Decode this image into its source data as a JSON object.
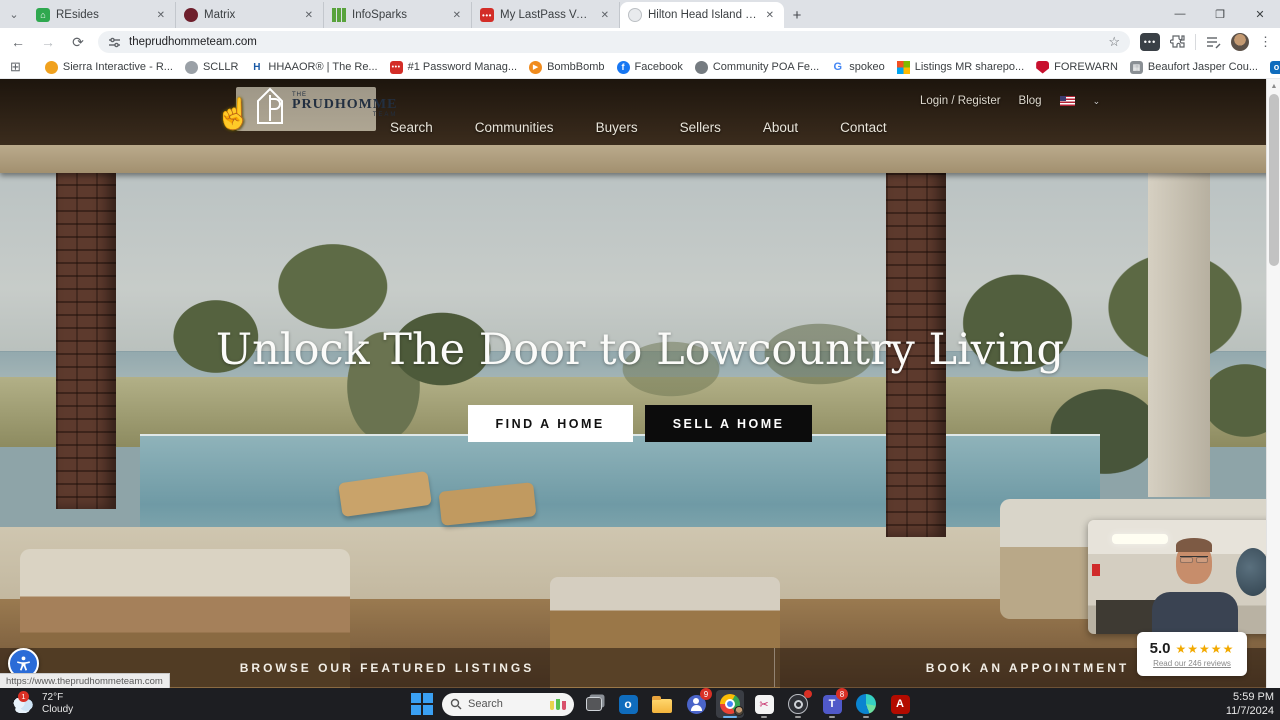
{
  "browser": {
    "tabs": [
      {
        "title": "REsides",
        "icon": "resides-favicon"
      },
      {
        "title": "Matrix",
        "icon": "matrix-favicon"
      },
      {
        "title": "InfoSparks",
        "icon": "infosparks-favicon"
      },
      {
        "title": "My LastPass Vault",
        "icon": "lastpass-favicon"
      },
      {
        "title": "Hilton Head Island Real Estate",
        "icon": "site-favicon",
        "active": true
      }
    ],
    "url": "theprudhommeteam.com",
    "bookmarks": [
      {
        "label": "Sierra Interactive - R...",
        "icon": "sierra-icon"
      },
      {
        "label": "SCLLR",
        "icon": "scllr-icon"
      },
      {
        "label": "HHAAOR® | The Re...",
        "icon": "hhaaor-icon",
        "glyph": "H"
      },
      {
        "label": "#1 Password Manag...",
        "icon": "lastpass-icon",
        "glyph": "•••"
      },
      {
        "label": "BombBomb",
        "icon": "bombbomb-icon",
        "glyph": "▶"
      },
      {
        "label": "Facebook",
        "icon": "facebook-icon",
        "glyph": "f"
      },
      {
        "label": "Community POA Fe...",
        "icon": "community-icon"
      },
      {
        "label": "spokeo",
        "icon": "google-icon",
        "glyph": "G"
      },
      {
        "label": "Listings MR sharepo...",
        "icon": "microsoft-icon"
      },
      {
        "label": "FOREWARN",
        "icon": "forewarn-shield-icon"
      },
      {
        "label": "Beaufort Jasper Cou...",
        "icon": "building-icon",
        "glyph": "▦"
      },
      {
        "label": "Raveis EMail - Outlo...",
        "icon": "outlook-icon",
        "glyph": "o"
      },
      {
        "label": "** Welcome to The...",
        "icon": "globe-icon",
        "glyph": "⊕"
      }
    ],
    "all_bookmarks_label": "All Bookmarks"
  },
  "page": {
    "logo": {
      "the": "THE",
      "name": "PRUDHOMME",
      "team": "TEAM"
    },
    "nav": [
      "Search",
      "Communities",
      "Buyers",
      "Sellers",
      "About",
      "Contact"
    ],
    "account_link": "Login / Register",
    "blog_link": "Blog",
    "hero_title": "Unlock The Door to Lowcountry Living",
    "cta_find": "FIND A HOME",
    "cta_sell": "SELL A HOME",
    "strip_left": "BROWSE OUR FEATURED LISTINGS",
    "strip_right": "BOOK AN APPOINTMENT",
    "reviews": {
      "score": "5.0",
      "stars": "★★★★★",
      "link": "Read our 246 reviews"
    },
    "status_url": "https://www.theprudhommeteam.com",
    "colors": {
      "cta_dark": "#0c0c0c",
      "star_gold": "#f2a900",
      "a11y_blue": "#2a6bd7"
    }
  },
  "taskbar": {
    "weather": {
      "badge": "1",
      "temp": "72°F",
      "condition": "Cloudy"
    },
    "search_label": "Search",
    "teams_classic_badge": "9",
    "teams_badge": "8",
    "clock": {
      "time": "5:59 PM",
      "date": "11/7/2024"
    }
  }
}
